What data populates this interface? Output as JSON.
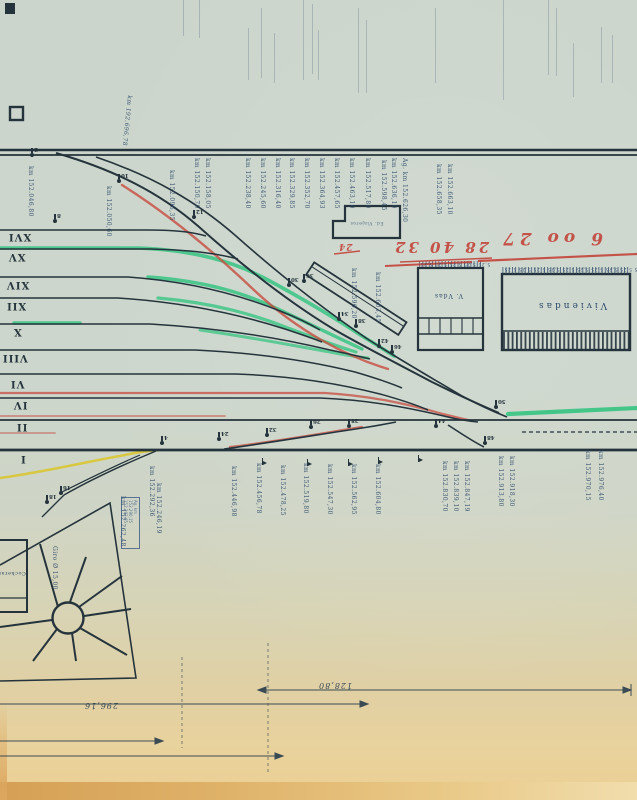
{
  "document": {
    "type": "scanned railway station track plan (upside-down scan)",
    "language": "Spanish"
  },
  "colors": {
    "paper": "#ccd6cc",
    "paper_warm": "#e9d29c",
    "ink": "#25343c",
    "blue_ink": "#2e4a6b",
    "red": "#c84b40",
    "red_hand": "#c23b31",
    "green": "#2dc37d",
    "yellow": "#d9c632",
    "ghost": "#5c7186"
  },
  "romans": [
    {
      "n": "XVI",
      "x": 8,
      "y": 231
    },
    {
      "n": "XV",
      "x": 8,
      "y": 251
    },
    {
      "n": "XIV",
      "x": 6,
      "y": 279
    },
    {
      "n": "XII",
      "x": 6,
      "y": 300
    },
    {
      "n": "X",
      "x": 13,
      "y": 326
    },
    {
      "n": "VIII",
      "x": 2,
      "y": 352
    },
    {
      "n": "VI",
      "x": 10,
      "y": 378
    },
    {
      "n": "IV",
      "x": 13,
      "y": 399
    },
    {
      "n": "II",
      "x": 16,
      "y": 421
    },
    {
      "n": "I",
      "x": 20,
      "y": 453
    }
  ],
  "km_labels": [
    {
      "t": "km 152.046,80",
      "x": 34,
      "y": 166
    },
    {
      "t": "km 152.050,60",
      "x": 112,
      "y": 186
    },
    {
      "t": "km 152.096,35",
      "x": 175,
      "y": 170
    },
    {
      "t": "km 152.150,70",
      "x": 200,
      "y": 158
    },
    {
      "t": "km 152.158,05",
      "x": 211,
      "y": 158
    },
    {
      "t": "km 152.238,40",
      "x": 251,
      "y": 158
    },
    {
      "t": "km 152.245,60",
      "x": 266,
      "y": 158
    },
    {
      "t": "km 152.316,40",
      "x": 281,
      "y": 158
    },
    {
      "t": "km 152.329,85",
      "x": 295,
      "y": 158
    },
    {
      "t": "km 152.352,70",
      "x": 310,
      "y": 158
    },
    {
      "t": "km 152.364,93",
      "x": 325,
      "y": 158
    },
    {
      "t": "km 152.457,65",
      "x": 340,
      "y": 158
    },
    {
      "t": "km 152.463,10",
      "x": 355,
      "y": 158
    },
    {
      "t": "km 152.517,80",
      "x": 371,
      "y": 158
    },
    {
      "t": "km 152.598,45",
      "x": 387,
      "y": 160
    },
    {
      "t": "km 152.636,10",
      "x": 397,
      "y": 158
    },
    {
      "t": "Ag. km 152.626,30",
      "x": 408,
      "y": 158
    },
    {
      "t": "km 152.658,35",
      "x": 442,
      "y": 164
    },
    {
      "t": "km 152.663,10",
      "x": 453,
      "y": 164
    },
    {
      "t": "km 152.596,20",
      "x": 357,
      "y": 268
    },
    {
      "t": "km 152.603,45",
      "x": 381,
      "y": 272
    },
    {
      "t": "km 152.292,36",
      "x": 155,
      "y": 466
    },
    {
      "t": "km 152.446,98",
      "x": 237,
      "y": 466
    },
    {
      "t": "km 152.456,78",
      "x": 262,
      "y": 463
    },
    {
      "t": "km 152.478,25",
      "x": 286,
      "y": 465
    },
    {
      "t": "km 152.519,80",
      "x": 309,
      "y": 463
    },
    {
      "t": "km 152.547,30",
      "x": 333,
      "y": 464
    },
    {
      "t": "km 152.562,95",
      "x": 357,
      "y": 464
    },
    {
      "t": "km 152.604,80",
      "x": 381,
      "y": 464
    },
    {
      "t": "km 152.830,70",
      "x": 448,
      "y": 461
    },
    {
      "t": "km 152.839,10",
      "x": 459,
      "y": 461
    },
    {
      "t": "km 152.847,19",
      "x": 470,
      "y": 461
    },
    {
      "t": "km 152.913,80",
      "x": 504,
      "y": 456
    },
    {
      "t": "km 152.918,30",
      "x": 515,
      "y": 456
    },
    {
      "t": "km 152.970,15",
      "x": 591,
      "y": 450
    },
    {
      "t": "km 152.976,40",
      "x": 604,
      "y": 450
    },
    {
      "t": "km 152.262,48",
      "x": 126,
      "y": 496
    },
    {
      "t": "km 152.246,19",
      "x": 162,
      "y": 483
    },
    {
      "t": "Giro Ø 15,00",
      "x": 58,
      "y": 546
    }
  ],
  "diag_label": {
    "t": "km 192.696,78",
    "x": 133,
    "y": 96
  },
  "markers": [
    {
      "n": "2",
      "x": 30,
      "y": 153
    },
    {
      "n": "10",
      "x": 117,
      "y": 179
    },
    {
      "n": "12",
      "x": 192,
      "y": 215
    },
    {
      "n": "8",
      "x": 53,
      "y": 219
    },
    {
      "n": "30",
      "x": 287,
      "y": 283
    },
    {
      "n": "36",
      "x": 302,
      "y": 279
    },
    {
      "n": "34",
      "x": 337,
      "y": 317
    },
    {
      "n": "38",
      "x": 354,
      "y": 324
    },
    {
      "n": "42",
      "x": 377,
      "y": 344
    },
    {
      "n": "46",
      "x": 390,
      "y": 350
    },
    {
      "n": "50",
      "x": 494,
      "y": 405
    },
    {
      "n": "44",
      "x": 434,
      "y": 424
    },
    {
      "n": "48",
      "x": 483,
      "y": 441
    },
    {
      "n": "4",
      "x": 160,
      "y": 441
    },
    {
      "n": "24",
      "x": 217,
      "y": 437
    },
    {
      "n": "32",
      "x": 265,
      "y": 433
    },
    {
      "n": "26",
      "x": 309,
      "y": 425
    },
    {
      "n": "28",
      "x": 347,
      "y": 424
    },
    {
      "n": "16",
      "x": 59,
      "y": 491
    },
    {
      "n": "18",
      "x": 45,
      "y": 500
    }
  ],
  "flags": [
    {
      "x": 262,
      "y": 458
    },
    {
      "x": 307,
      "y": 459
    },
    {
      "x": 348,
      "y": 459
    },
    {
      "x": 378,
      "y": 457
    },
    {
      "x": 418,
      "y": 455
    }
  ],
  "ghosts": [
    {
      "x": 183,
      "y": 0,
      "h": 36
    },
    {
      "x": 199,
      "y": 0,
      "h": 38
    },
    {
      "x": 248,
      "y": 28,
      "h": 52
    },
    {
      "x": 261,
      "y": 8,
      "h": 70
    },
    {
      "x": 274,
      "y": 33,
      "h": 50
    },
    {
      "x": 303,
      "y": 0,
      "h": 80
    },
    {
      "x": 312,
      "y": 4,
      "h": 70
    },
    {
      "x": 318,
      "y": 30,
      "h": 50
    },
    {
      "x": 358,
      "y": 8,
      "h": 85
    },
    {
      "x": 366,
      "y": 20,
      "h": 73
    },
    {
      "x": 435,
      "y": 8,
      "h": 75
    },
    {
      "x": 503,
      "y": 0,
      "h": 100
    },
    {
      "x": 548,
      "y": 0,
      "h": 75
    },
    {
      "x": 556,
      "y": 8,
      "h": 68
    },
    {
      "x": 573,
      "y": 43,
      "h": 54
    },
    {
      "x": 601,
      "y": 27,
      "h": 56
    },
    {
      "x": 612,
      "y": 35,
      "h": 48
    }
  ],
  "handwriting": {
    "left": "28 40 32",
    "right": "6 oo 27",
    "small": "24"
  },
  "buildings": {
    "wide_label": "Viviendas",
    "tall_label": "V. Vdas",
    "station_label": "Ed. Viajeros",
    "shed_label": "Cocheras",
    "tall_digits": "5,25 5,25 5,25 5,25 5,25",
    "wide_digits": "5,25 5,25 5,25 5,25 5,25 5,25 5,25 5,25 5,25 5,25"
  },
  "dimensions": {
    "d1": "128,80",
    "d2": "296,16"
  },
  "stamp": {
    "line1": "Ag. km",
    "line2": "152.290,15",
    "line3": "152.293,65"
  }
}
